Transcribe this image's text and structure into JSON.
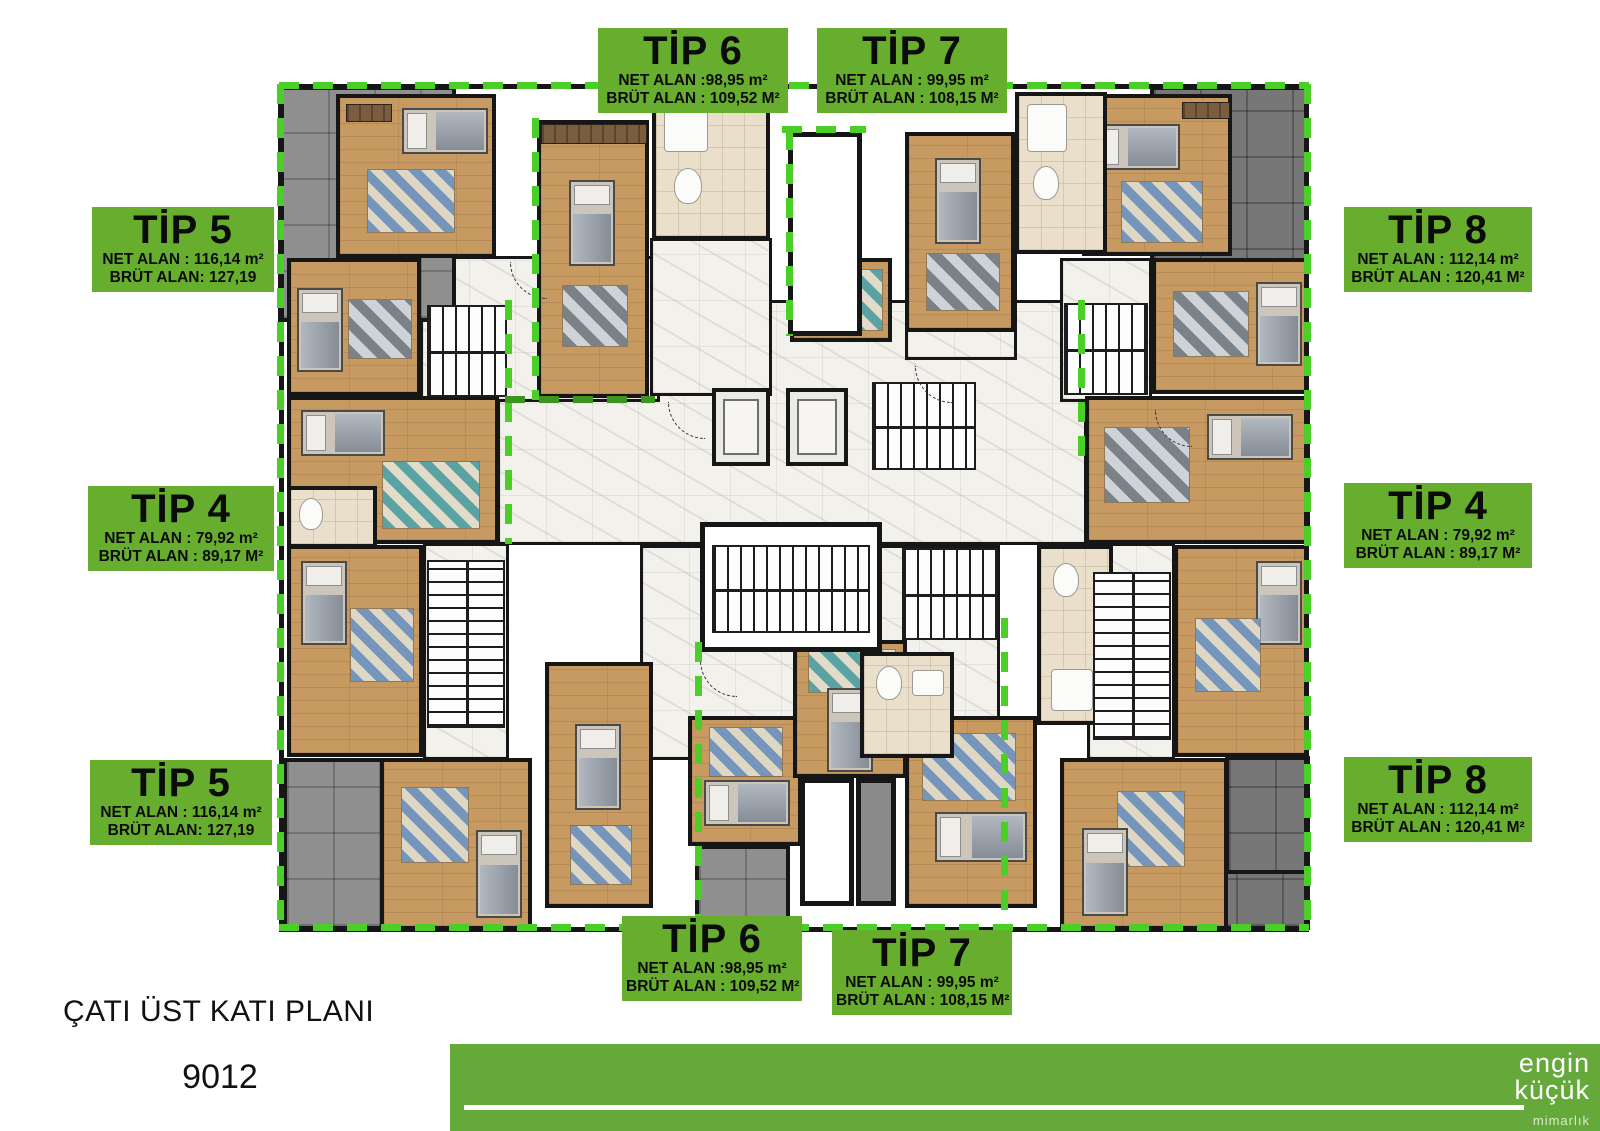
{
  "plan": {
    "title": "ÇATI ÜST KATI PLANI",
    "number": "9012"
  },
  "unit_labels": [
    {
      "id": "tip6-top",
      "title": "TİP 6",
      "net": "NET ALAN :98,95 m²",
      "brut": "BRÜT ALAN : 109,52 M²"
    },
    {
      "id": "tip7-top",
      "title": "TİP 7",
      "net": "NET ALAN : 99,95 m²",
      "brut": "BRÜT ALAN : 108,15 M²"
    },
    {
      "id": "tip5-left-top",
      "title": "TİP 5",
      "net": "NET ALAN : 116,14 m²",
      "brut": "BRÜT ALAN: 127,19"
    },
    {
      "id": "tip4-left",
      "title": "TİP 4",
      "net": "NET ALAN : 79,92 m²",
      "brut": "BRÜT ALAN : 89,17 M²"
    },
    {
      "id": "tip5-left-bottom",
      "title": "TİP 5",
      "net": "NET ALAN : 116,14 m²",
      "brut": "BRÜT ALAN: 127,19"
    },
    {
      "id": "tip8-right-top",
      "title": "TİP 8",
      "net": "NET ALAN : 112,14 m²",
      "brut": "BRÜT ALAN : 120,41 M²"
    },
    {
      "id": "tip4-right",
      "title": "TİP 4",
      "net": "NET ALAN : 79,92 m²",
      "brut": "BRÜT ALAN : 89,17 M²"
    },
    {
      "id": "tip8-right-bottom",
      "title": "TİP 8",
      "net": "NET ALAN : 112,14 m²",
      "brut": "BRÜT ALAN : 120,41 M²"
    },
    {
      "id": "tip6-bottom",
      "title": "TİP 6",
      "net": "NET ALAN :98,95 m²",
      "brut": "BRÜT ALAN : 109,52 M²"
    },
    {
      "id": "tip7-bottom",
      "title": "TİP 7",
      "net": "NET ALAN : 99,95 m²",
      "brut": "BRÜT ALAN : 108,15 M²"
    }
  ],
  "footer": {
    "logo_line1": "engin",
    "logo_line2": "küçük",
    "logo_line3": "mimarlık"
  },
  "colors": {
    "label_green": "#68ae2e",
    "boundary_dash_green": "#4cce28",
    "footer_bar_green": "#64a93a",
    "wood_floor": "#c79a62",
    "terrace_gray": "#8f8f8f",
    "corridor_marble": "#f3f1ec",
    "wall_black": "#161616"
  }
}
